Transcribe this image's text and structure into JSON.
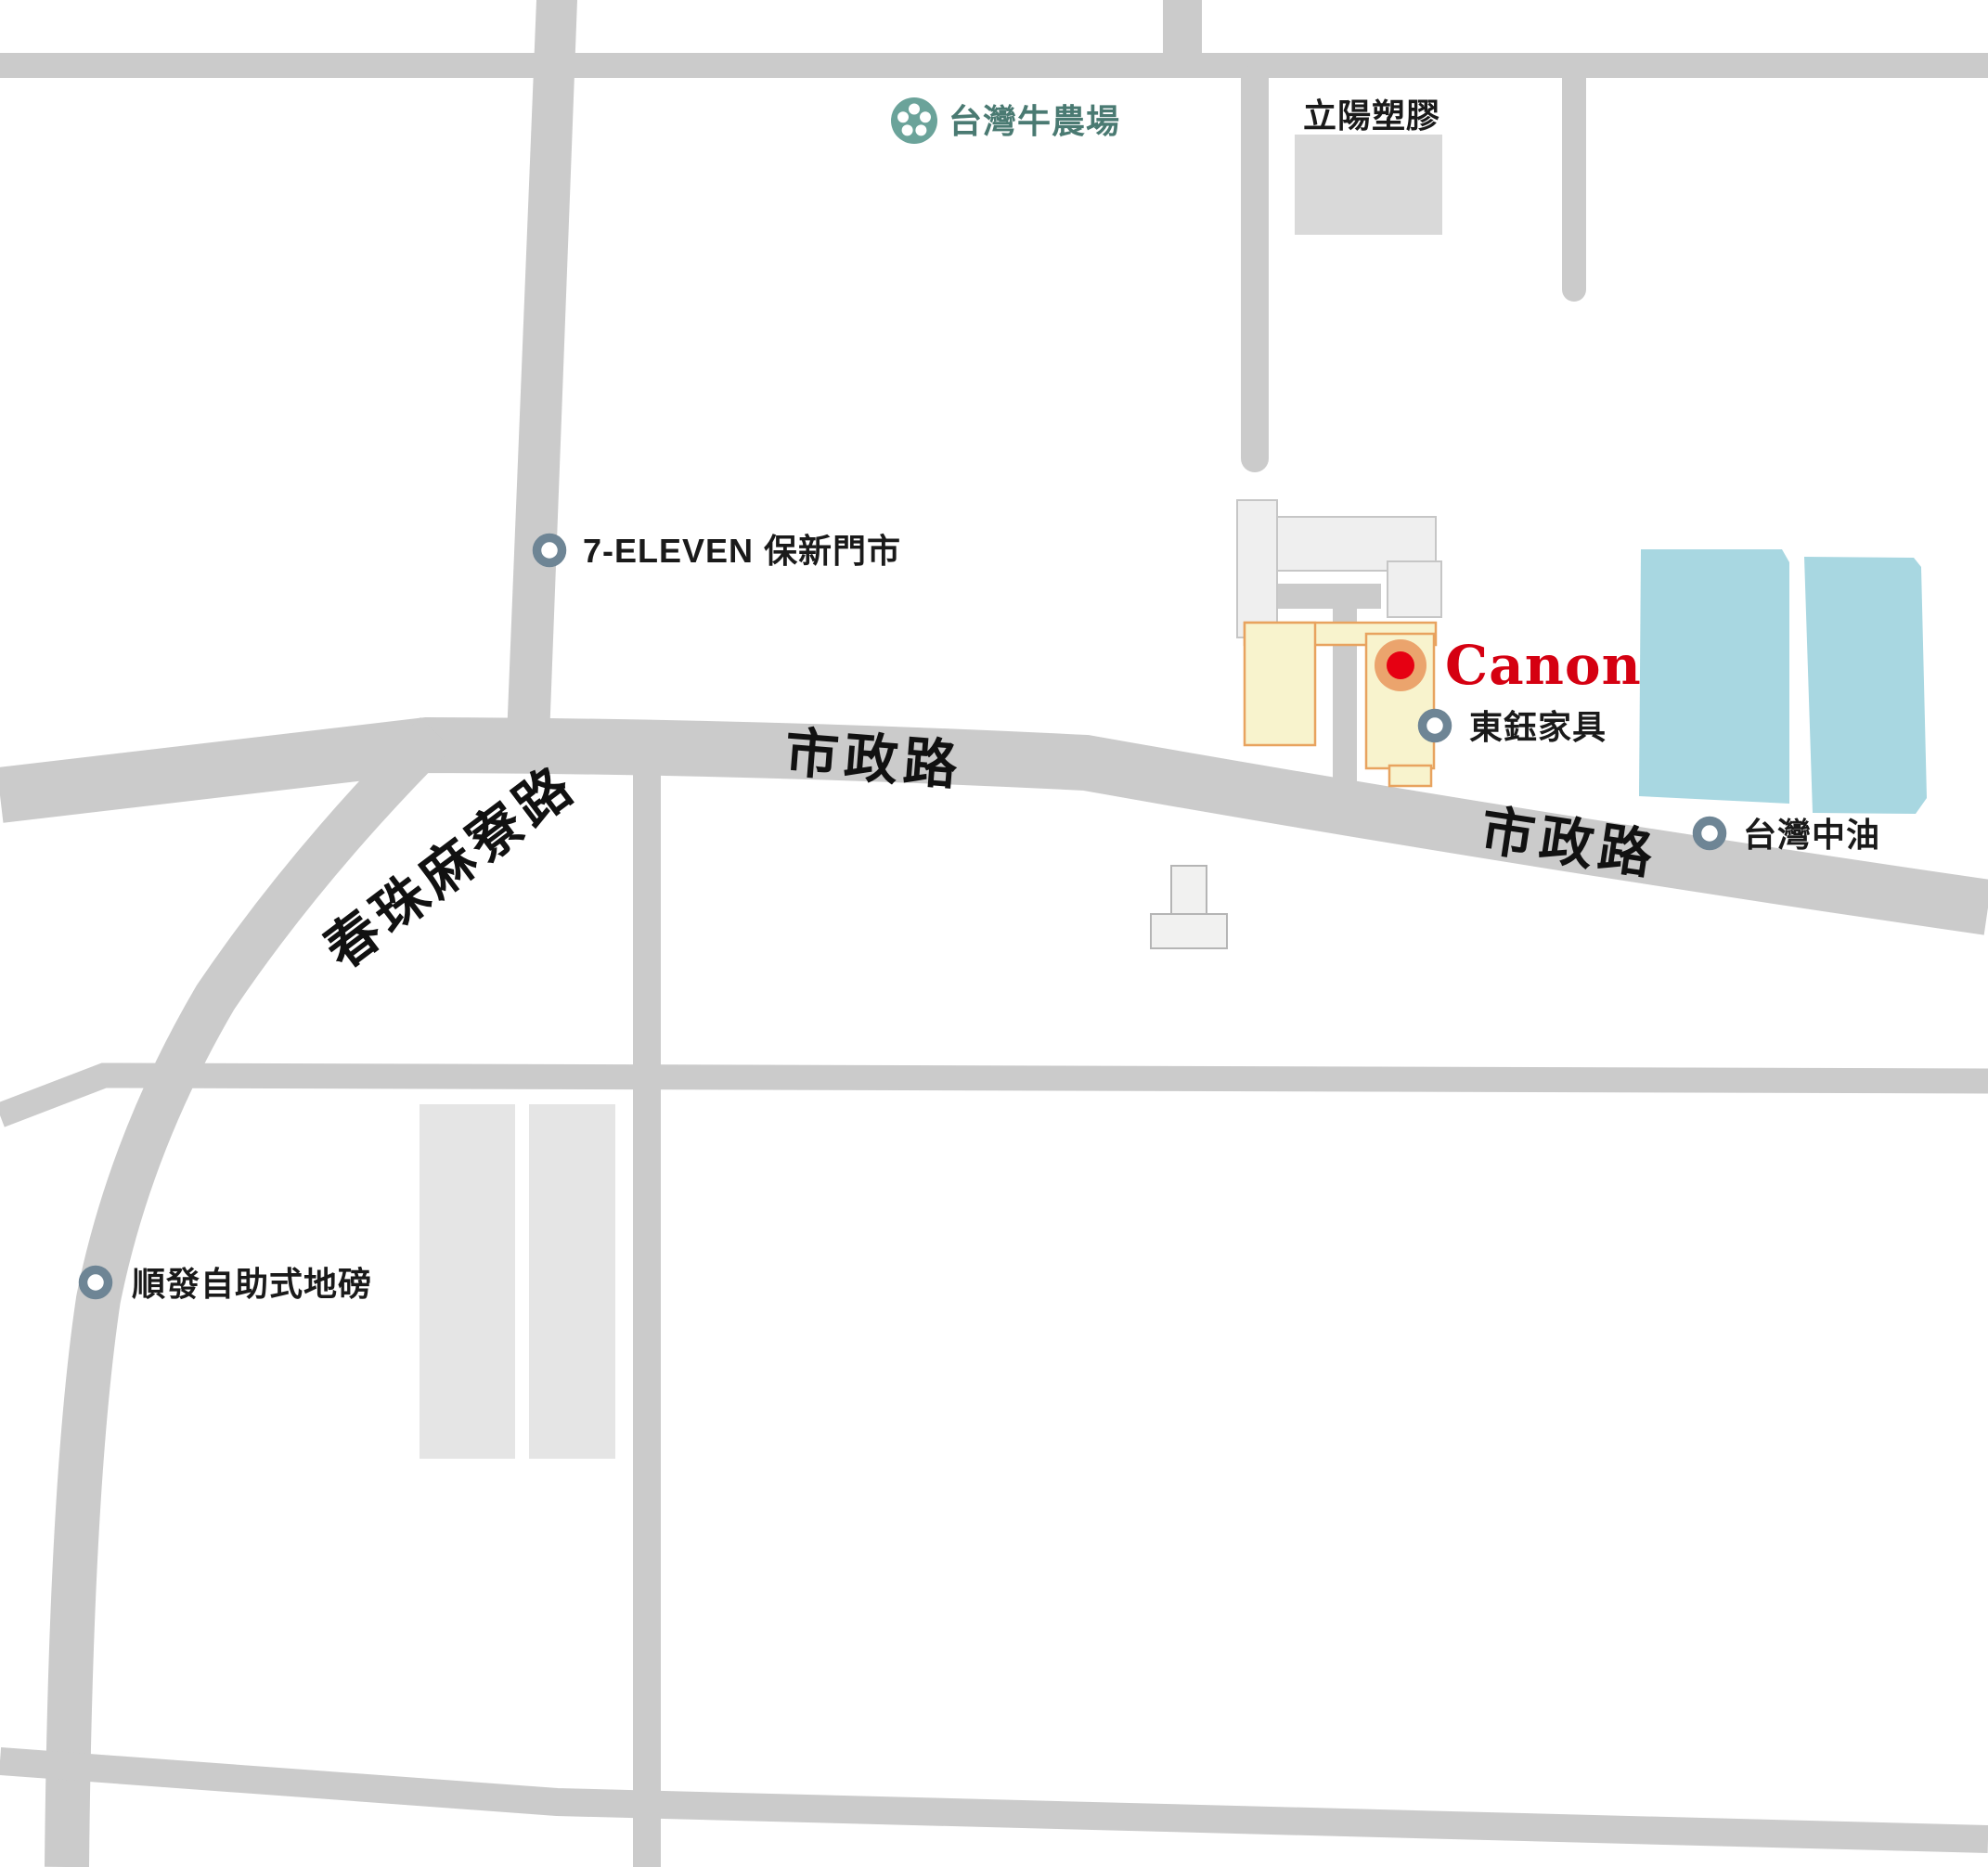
{
  "map": {
    "type": "static-location-map",
    "colors": {
      "road": "#cbcbcb",
      "building_gray": "#efefef",
      "building_dark_gray": "#d9d9d9",
      "building_yellow": "#f8f3cd",
      "building_yellow_border": "#e8a35f",
      "building_blue": "#a8d7e1",
      "marker_ring": "#6e8595",
      "canon_red": "#d50011",
      "canon_dot_red": "#e60012",
      "canon_halo_orange": "#eba46d",
      "farm_icon_teal": "#6ba39a",
      "farm_label_teal": "#4a7a72",
      "label_black": "#1a1a1a"
    },
    "road_labels": {
      "shizheng_west": "市政路",
      "shizheng_east": "市政路",
      "chunzhu_maliao": "春珠麻寮路"
    },
    "pois": {
      "farm": {
        "label": "台灣牛農場",
        "marker": "teal-flower-icon"
      },
      "liyang": {
        "label": "立陽塑膠",
        "marker": "gray-building"
      },
      "seven": {
        "label": "7-ELEVEN 保新門市",
        "marker": "ring"
      },
      "canon": {
        "label": "Canon",
        "marker": "red-dot-with-orange-halo"
      },
      "dongyu": {
        "label": "東鈺家具",
        "marker": "ring"
      },
      "cpc": {
        "label": "台灣中油",
        "marker": "ring"
      },
      "shunfa": {
        "label": "順發自助式地磅",
        "marker": "ring"
      }
    }
  }
}
